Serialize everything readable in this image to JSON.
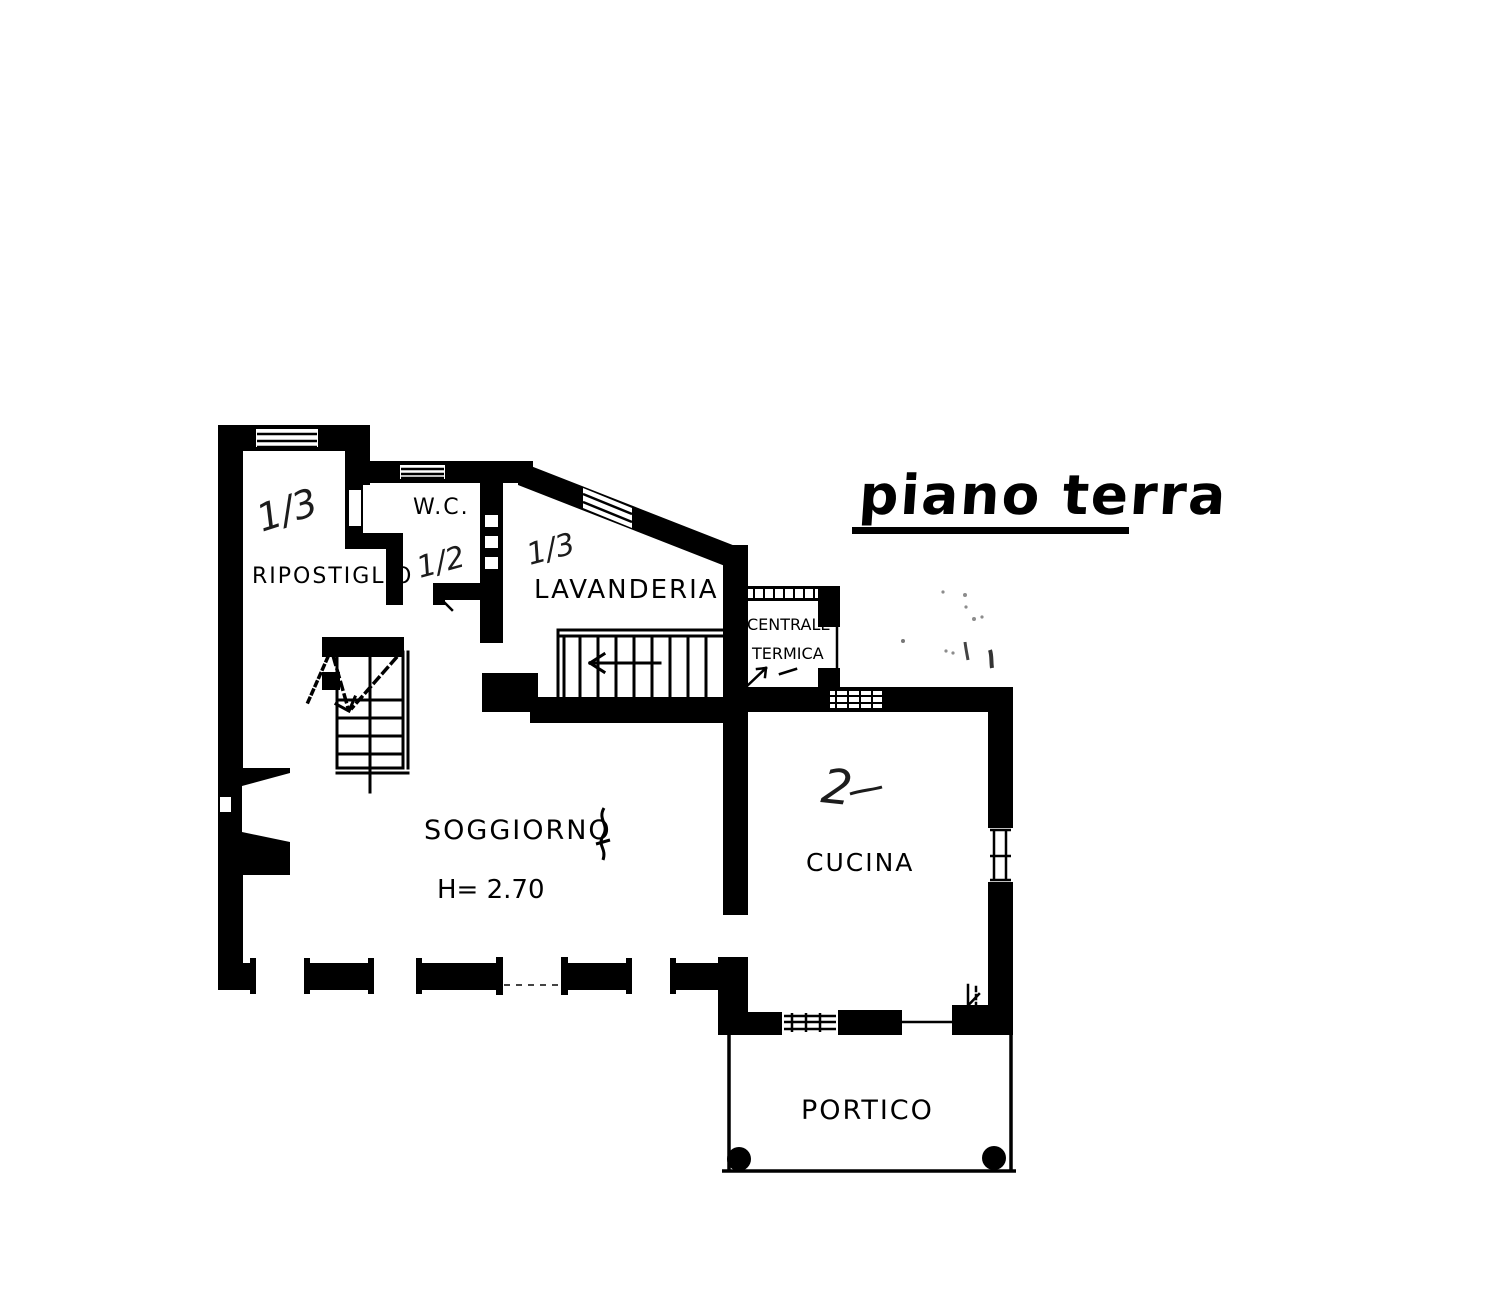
{
  "title": "piano terra",
  "rooms": {
    "ripostiglio": {
      "label": "RIPOSTIGLIO",
      "fraction": "1/3"
    },
    "wc": {
      "label": "W.C.",
      "fraction": "1/2"
    },
    "lavanderia": {
      "label": "LAVANDERIA",
      "fraction": "1/3"
    },
    "centrale_termica": {
      "label_line1": "CENTRALE",
      "label_line2": "TERMICA"
    },
    "soggiorno": {
      "label": "SOGGIORNO",
      "height_note": "H= 2.70"
    },
    "cucina": {
      "label": "CUCINA",
      "mark": "2"
    },
    "portico": {
      "label": "PORTICO"
    }
  },
  "colors": {
    "ink": "#000000",
    "paper": "#ffffff",
    "pencil": "#8c8c8c"
  }
}
